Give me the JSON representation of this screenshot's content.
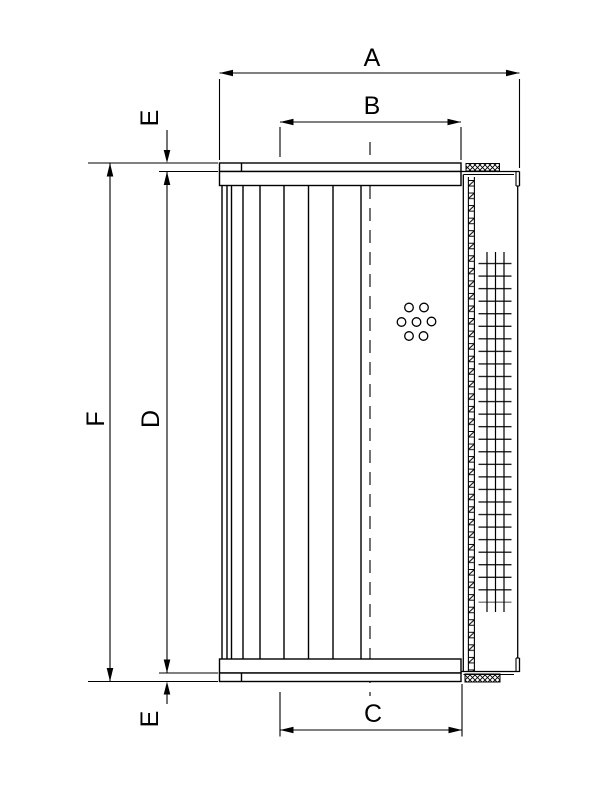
{
  "drawing": {
    "description": "Hydraulic filter element dimensional drawing",
    "dimensions": {
      "overall_width": "A",
      "seal_width": "B",
      "base_width": "C",
      "core_height": "D",
      "end_offset": "E",
      "overall_height": "F"
    }
  }
}
